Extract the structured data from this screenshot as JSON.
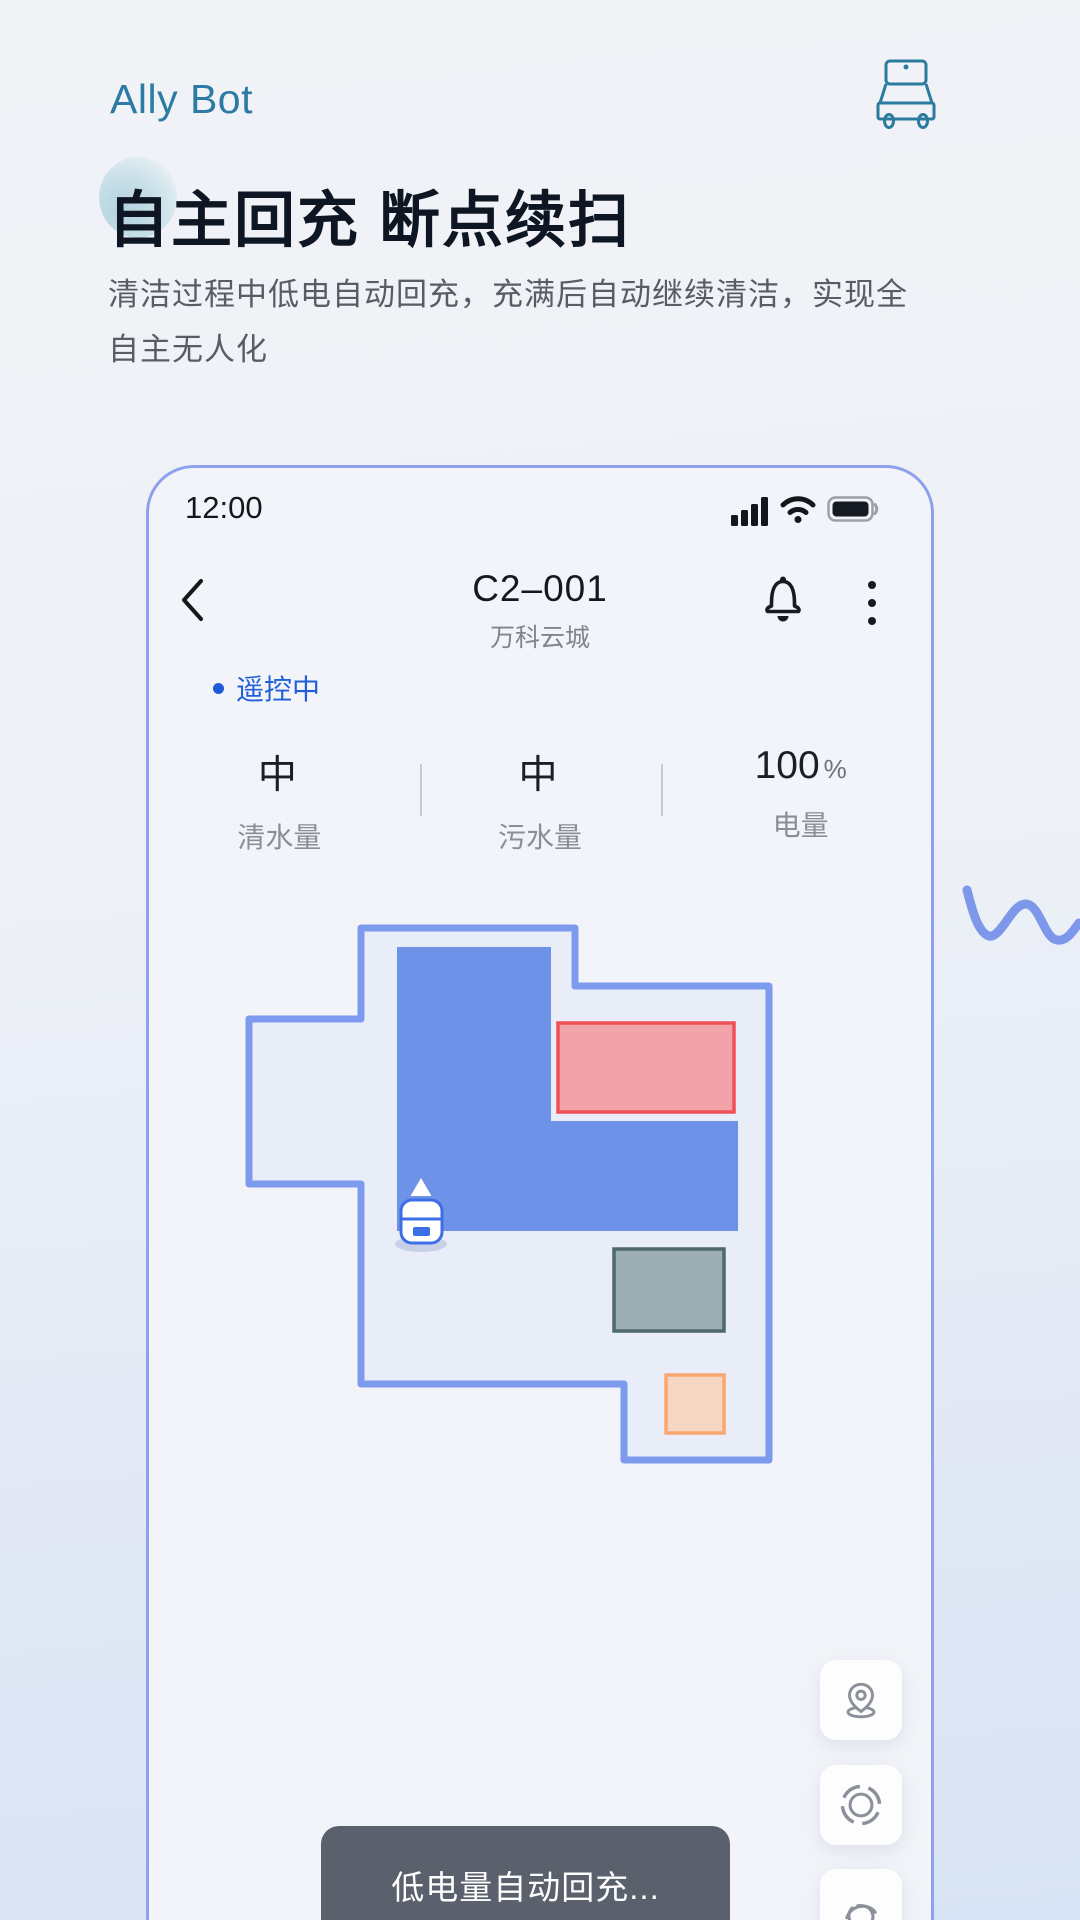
{
  "hero": {
    "brand": "Ally Bot",
    "headline": "自主回充 断点续扫",
    "description": "清洁过程中低电自动回充，充满后自动继续清洁，实现全自主无人化",
    "brand_icon": "robot-scrubber-icon"
  },
  "phone": {
    "status_bar": {
      "time": "12:00",
      "icons": [
        "cellular-signal-icon",
        "wifi-icon",
        "battery-icon"
      ]
    },
    "nav": {
      "back_icon": "chevron-left-icon",
      "title": "C2–001",
      "subtitle": "万科云城",
      "bell_icon": "notification-bell-icon",
      "menu_icon": "kebab-menu-icon"
    },
    "robot_status": {
      "label": "遥控中"
    },
    "stats": [
      {
        "value": "中",
        "unit": "",
        "label": "清水量"
      },
      {
        "value": "中",
        "unit": "",
        "label": "污水量"
      },
      {
        "value": "100",
        "unit": "%",
        "label": "电量"
      }
    ],
    "map": {
      "zones": [
        {
          "id": "no-go-zone",
          "stroke": "#ef5056",
          "fill": "#f2a3a9"
        },
        {
          "id": "obstacle-zone",
          "stroke": "#4d6a68",
          "fill": "#9cadb3"
        },
        {
          "id": "caution-zone",
          "stroke": "#f9a76f",
          "fill": "#f6d6c3"
        }
      ],
      "outline_color": "#7c9aee",
      "cleaned_color": "#6e92e8",
      "robot_marker": "robot-position-marker"
    },
    "action_buttons": [
      {
        "icon": "map-pin-icon"
      },
      {
        "icon": "life-ring-icon"
      },
      {
        "icon": "relocate-swirl-icon"
      }
    ],
    "toast": {
      "message": "低电量自动回充..."
    }
  },
  "colors": {
    "brand_teal": "#2c7ba4",
    "accent_blue": "#2160d9",
    "phone_border": "#8da1ee",
    "toast_bg": "#5b616c",
    "headline_text": "#0d1622",
    "body_text": "#575d66"
  }
}
